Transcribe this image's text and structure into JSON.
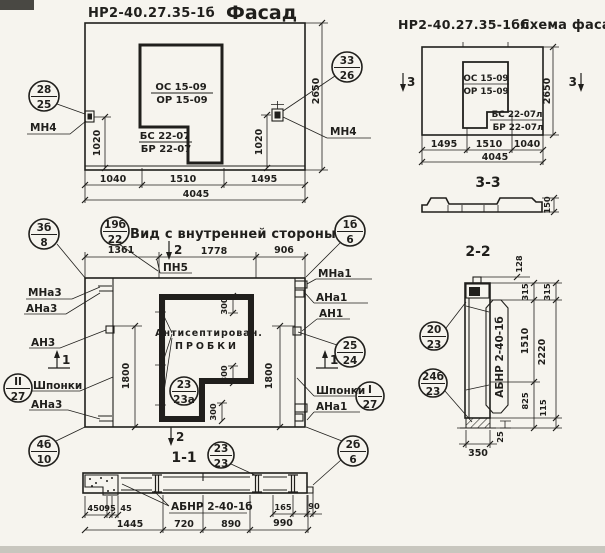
{
  "colors": {
    "ink": "#201f1c",
    "paper": "#f6f4ee"
  },
  "facade": {
    "code": "НР2-40.27.35-1б",
    "title": "Фасад",
    "callout_left_top": "28",
    "callout_left_bot": "25",
    "callout_right_top": "33",
    "callout_right_bot": "26",
    "anchor_left": "МН4",
    "anchor_right": "МН4",
    "open_line1": "ОС 15-09",
    "open_line2": "ОР 15-09",
    "open_line3": "БС 22-07",
    "open_line4": "БР 22-07",
    "dim_left": "1020",
    "dim_right": "1020",
    "dim_height": "2650",
    "dim_b1": "1040",
    "dim_b2": "1510",
    "dim_b3": "1495",
    "dim_total": "4045"
  },
  "scheme": {
    "code": "НР2-40.27.35-1бл",
    "title": "Схема фасада",
    "open_line1": "ОС 15-09",
    "open_line2": "ОР 15-09",
    "open_line3": "БС 22-07л",
    "open_line4": "БР 22-07л",
    "dim_height": "2650",
    "dim_b1": "1495",
    "dim_b2": "1510",
    "dim_b3": "1040",
    "dim_total": "4045",
    "mark_left": "3",
    "mark_right": "3",
    "section_label": "3-3",
    "profile_dim": "150"
  },
  "inner": {
    "title": "Вид с внутренней стороны",
    "pn5": "ПН5",
    "dim_t1": "1361",
    "dim_t2": "1778",
    "dim_t3": "906",
    "dim_v_left": "1800",
    "dim_v_right": "1800",
    "dim_300a": "300",
    "dim_300b": "300",
    "dim_300c": "300",
    "mark2_top": "2",
    "mark2_bot": "2",
    "mark1_left": "1",
    "mark1_right": "1",
    "lbl_mna3": "МНа3",
    "lbl_ana3": "АНа3",
    "lbl_an3": "АН3",
    "lbl_shponki_l": "Шпонки",
    "lbl_ana3b": "АНа3",
    "lbl_mna1": "МНа1",
    "lbl_ana1": "АНа1",
    "lbl_an1": "АН1",
    "lbl_shponki_r": "Шпонки",
    "lbl_ana1b": "АНа1",
    "note1": "Антисептирован.",
    "note2": "ПРОБКИ",
    "section_label": "1-1",
    "co_3b8_top": "3б",
    "co_3b8_bot": "8",
    "co_19b22_top": "19б",
    "co_19b22_bot": "22",
    "co_1b6_top": "1б",
    "co_1b6_bot": "6",
    "co_ii27_top": "II",
    "co_ii27_bot": "27",
    "co_4b10_top": "4б",
    "co_4b10_bot": "10",
    "co_2524_top": "25",
    "co_2524_bot": "24",
    "co_i27_top": "I",
    "co_i27_bot": "27",
    "co_2b6_top": "2б",
    "co_2b6_bot": "6",
    "co_2323a_top": "23",
    "co_2323a_bot": "23а",
    "co_2323_top": "23",
    "co_2323_bot": "23"
  },
  "sec11": {
    "name": "АБНР 2-40-1б",
    "d450": "450",
    "d95": "95",
    "d45": "45",
    "d165": "165",
    "d90": "90",
    "d1445": "1445",
    "d720": "720",
    "d890": "890",
    "d990": "990"
  },
  "sec22": {
    "label": "2-2",
    "name": "АБНР 2-40-1б",
    "co_2023_top": "20",
    "co_2023_bot": "23",
    "co_24b23_top": "24б",
    "co_24b23_bot": "23",
    "d128": "128",
    "d315i": "315",
    "d1510": "1510",
    "d825": "825",
    "d315o": "315",
    "d2220": "2220",
    "d115": "115",
    "d25": "25",
    "d350": "350"
  }
}
